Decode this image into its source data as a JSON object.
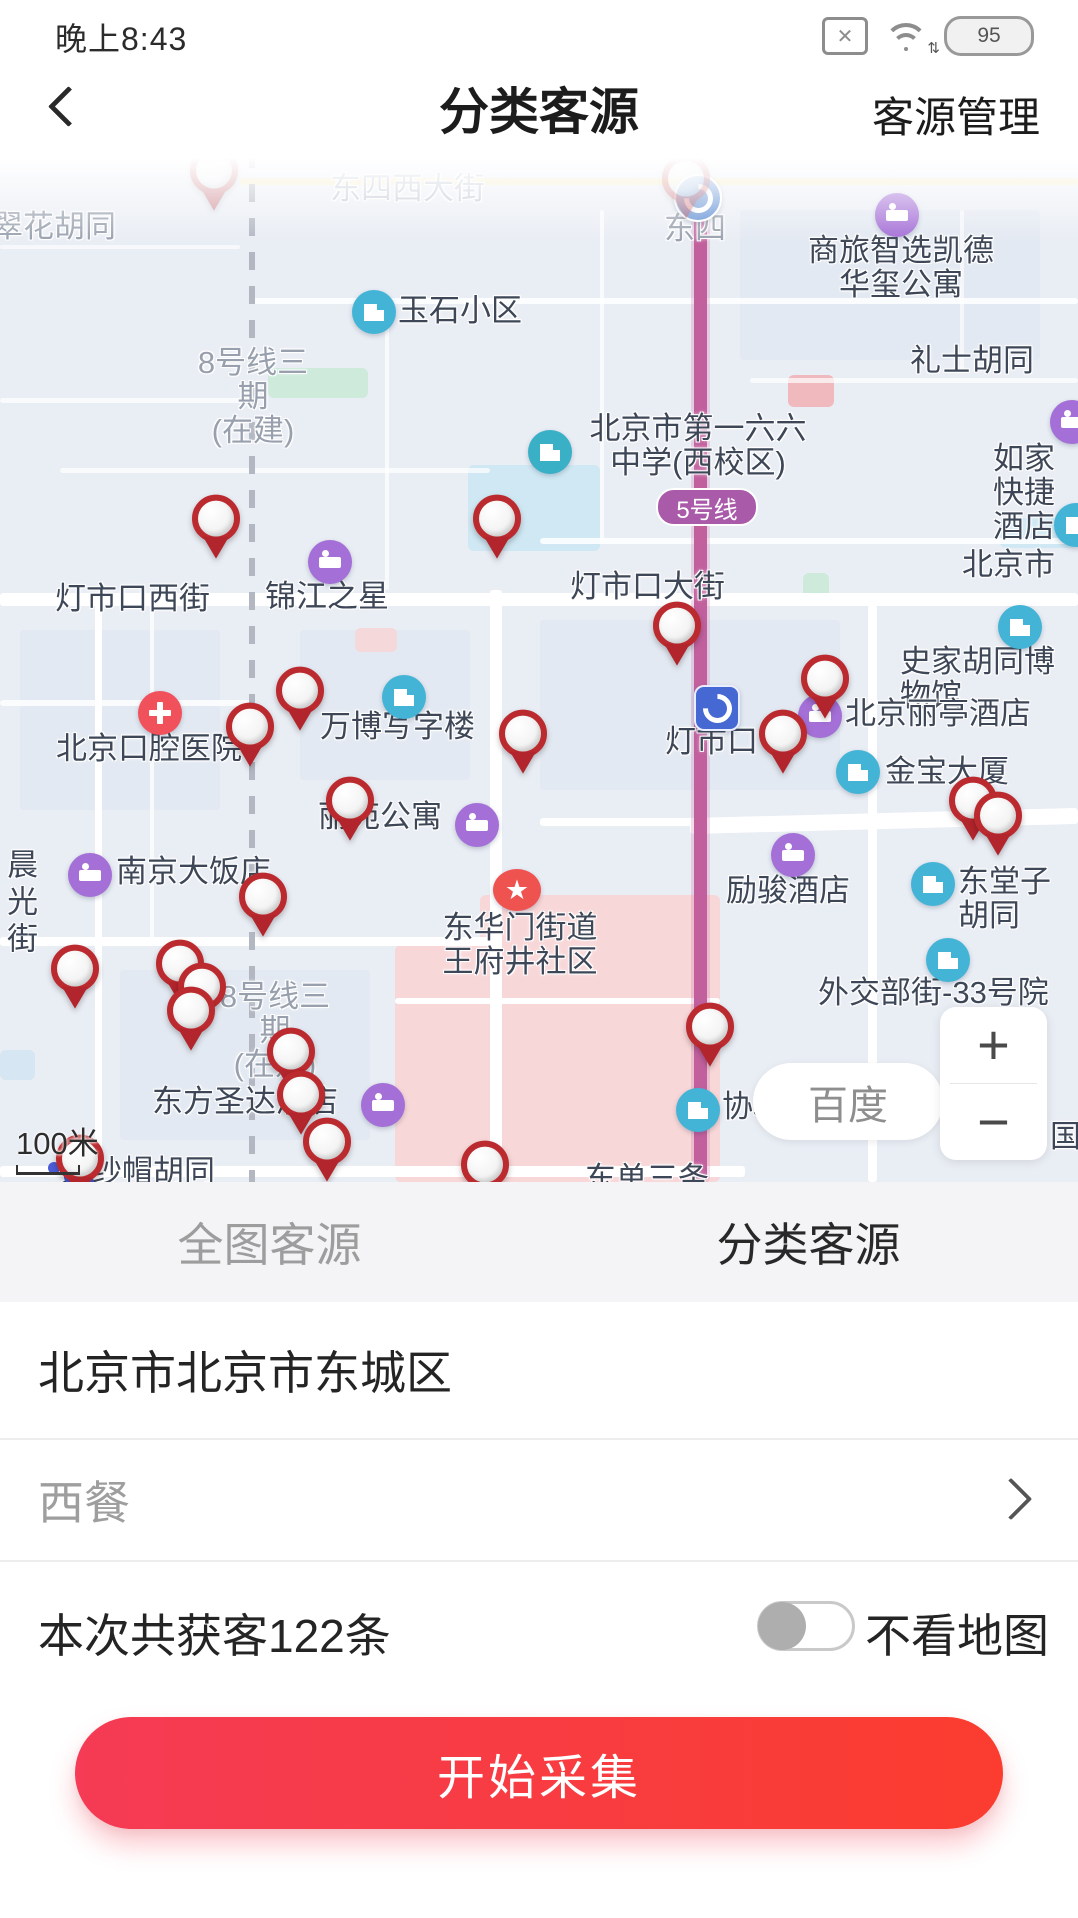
{
  "status": {
    "time": "晚上8:43",
    "battery": "95",
    "sim_icon": "sim-x-icon",
    "wifi_icon": "wifi-icon"
  },
  "header": {
    "title": "分类客源",
    "action": "客源管理",
    "back_icon": "back-chevron-icon"
  },
  "map": {
    "attribution": "百度",
    "scale": "100米",
    "zoom_in": "+",
    "zoom_out": "−",
    "line5_badge": "5号线",
    "labels": [
      {
        "t": "东四西大街",
        "x": 330,
        "y": 22,
        "c": "faint"
      },
      {
        "t": "翠花胡同",
        "x": -8,
        "y": 60,
        "c": "gray"
      },
      {
        "t": "东四",
        "x": 664,
        "y": 62,
        "c": "gray"
      },
      {
        "t": "商旅智选凯德\n华玺公寓",
        "x": 793,
        "y": 84,
        "c": "dark",
        "w": 216
      },
      {
        "t": "玉石小区",
        "x": 398,
        "y": 144,
        "c": "dark"
      },
      {
        "t": "礼士胡同",
        "x": 910,
        "y": 194,
        "c": "dark"
      },
      {
        "t": "8号线三期\n(在建)",
        "x": 186,
        "y": 196,
        "c": "gray",
        "w": 134
      },
      {
        "t": "北京市第一六六\n中学(西校区)",
        "x": 576,
        "y": 262,
        "c": "dark",
        "w": 244
      },
      {
        "t": "如家快捷酒店",
        "x": 993,
        "y": 292,
        "c": "dark"
      },
      {
        "t": "北京市",
        "x": 962,
        "y": 398,
        "c": "dark"
      },
      {
        "t": "灯市口西街",
        "x": 55,
        "y": 432,
        "c": "dark"
      },
      {
        "t": "锦江之星",
        "x": 265,
        "y": 430,
        "c": "dark"
      },
      {
        "t": "灯市口大街",
        "x": 570,
        "y": 420,
        "c": "dark"
      },
      {
        "t": "史家胡同博物馆",
        "x": 900,
        "y": 495,
        "c": "dark"
      },
      {
        "t": "北京口腔医院",
        "x": 56,
        "y": 582,
        "c": "dark"
      },
      {
        "t": "万博写字楼",
        "x": 320,
        "y": 560,
        "c": "dark"
      },
      {
        "t": "北京丽亭酒店",
        "x": 845,
        "y": 547,
        "c": "dark"
      },
      {
        "t": "灯市口",
        "x": 665,
        "y": 575,
        "c": "dark"
      },
      {
        "t": "金宝大厦",
        "x": 885,
        "y": 605,
        "c": "dark"
      },
      {
        "t": "丽苑公寓",
        "x": 318,
        "y": 650,
        "c": "dark"
      },
      {
        "t": "南京大饭店",
        "x": 116,
        "y": 705,
        "c": "dark"
      },
      {
        "t": "励骏酒店",
        "x": 726,
        "y": 724,
        "c": "dark"
      },
      {
        "t": "东堂子胡同",
        "x": 958,
        "y": 715,
        "c": "dark"
      },
      {
        "t": "晨光街",
        "x": 2,
        "y": 698,
        "c": "dark vert"
      },
      {
        "t": "东华门街道\n王府井社区",
        "x": 428,
        "y": 761,
        "c": "dark",
        "w": 184
      },
      {
        "t": "外交部街-33号院",
        "x": 818,
        "y": 826,
        "c": "dark"
      },
      {
        "t": "8号线三期\n(在建)",
        "x": 208,
        "y": 830,
        "c": "gray",
        "w": 134
      },
      {
        "t": "东方圣达酒店",
        "x": 152,
        "y": 935,
        "c": "dark"
      },
      {
        "t": "协和医院",
        "x": 722,
        "y": 940,
        "c": "dark"
      },
      {
        "t": "国",
        "x": 1050,
        "y": 970,
        "c": "dark"
      },
      {
        "t": "大纱帽胡同",
        "x": 60,
        "y": 1005,
        "c": "dark"
      },
      {
        "t": "东单三条",
        "x": 585,
        "y": 1012,
        "c": "dark"
      }
    ],
    "pois": [
      {
        "k": "metro",
        "x": 698,
        "y": 48,
        "n": "metro-dongsi"
      },
      {
        "k": "hotel",
        "x": 897,
        "y": 65,
        "n": "hotel"
      },
      {
        "k": "bldg",
        "x": 374,
        "y": 162,
        "n": "residential"
      },
      {
        "k": "school",
        "x": 550,
        "y": 302,
        "n": "school"
      },
      {
        "k": "hotel",
        "x": 1072,
        "y": 272,
        "n": "hotel"
      },
      {
        "k": "bldg",
        "x": 1076,
        "y": 375,
        "n": "building"
      },
      {
        "k": "hotel",
        "x": 330,
        "y": 412,
        "n": "hotel"
      },
      {
        "k": "museum",
        "x": 1020,
        "y": 477,
        "n": "museum"
      },
      {
        "k": "hospital",
        "x": 160,
        "y": 563,
        "n": "hospital"
      },
      {
        "k": "bldg",
        "x": 404,
        "y": 547,
        "n": "office"
      },
      {
        "k": "hotel",
        "x": 820,
        "y": 566,
        "n": "hotel"
      },
      {
        "k": "metrosq",
        "x": 717,
        "y": 558,
        "n": "metro-dengshikou"
      },
      {
        "k": "bldg",
        "x": 858,
        "y": 622,
        "n": "building"
      },
      {
        "k": "hotel",
        "x": 477,
        "y": 675,
        "n": "hotel"
      },
      {
        "k": "hotel",
        "x": 90,
        "y": 725,
        "n": "hotel"
      },
      {
        "k": "hotel",
        "x": 793,
        "y": 705,
        "n": "hotel"
      },
      {
        "k": "bldg",
        "x": 933,
        "y": 734,
        "n": "building"
      },
      {
        "k": "star",
        "x": 517,
        "y": 740,
        "n": "district-star"
      },
      {
        "k": "bldg",
        "x": 948,
        "y": 810,
        "n": "building"
      },
      {
        "k": "hotel",
        "x": 383,
        "y": 955,
        "n": "hotel"
      },
      {
        "k": "bldg",
        "x": 698,
        "y": 960,
        "n": "hospital-building"
      }
    ],
    "pins": [
      {
        "x": 214,
        "y": 32,
        "f": 1
      },
      {
        "x": 686,
        "y": 40,
        "f": 1
      },
      {
        "x": 216,
        "y": 380
      },
      {
        "x": 497,
        "y": 380
      },
      {
        "x": 677,
        "y": 487
      },
      {
        "x": 825,
        "y": 540
      },
      {
        "x": 783,
        "y": 595
      },
      {
        "x": 973,
        "y": 662
      },
      {
        "x": 998,
        "y": 677
      },
      {
        "x": 300,
        "y": 552
      },
      {
        "x": 250,
        "y": 588
      },
      {
        "x": 523,
        "y": 595
      },
      {
        "x": 350,
        "y": 662
      },
      {
        "x": 263,
        "y": 758
      },
      {
        "x": 75,
        "y": 830
      },
      {
        "x": 180,
        "y": 825
      },
      {
        "x": 202,
        "y": 848
      },
      {
        "x": 191,
        "y": 872
      },
      {
        "x": 291,
        "y": 913
      },
      {
        "x": 301,
        "y": 956
      },
      {
        "x": 327,
        "y": 1003
      },
      {
        "x": 710,
        "y": 888
      },
      {
        "x": 80,
        "y": 1020
      },
      {
        "x": 485,
        "y": 1026
      }
    ]
  },
  "tabs": [
    {
      "label": "全图客源",
      "active": false
    },
    {
      "label": "分类客源",
      "active": true
    }
  ],
  "rows": {
    "region": "北京市北京市东城区",
    "category": "西餐",
    "result": "本次共获客122条",
    "toggle_label": "不看地图"
  },
  "cta": "开始采集"
}
